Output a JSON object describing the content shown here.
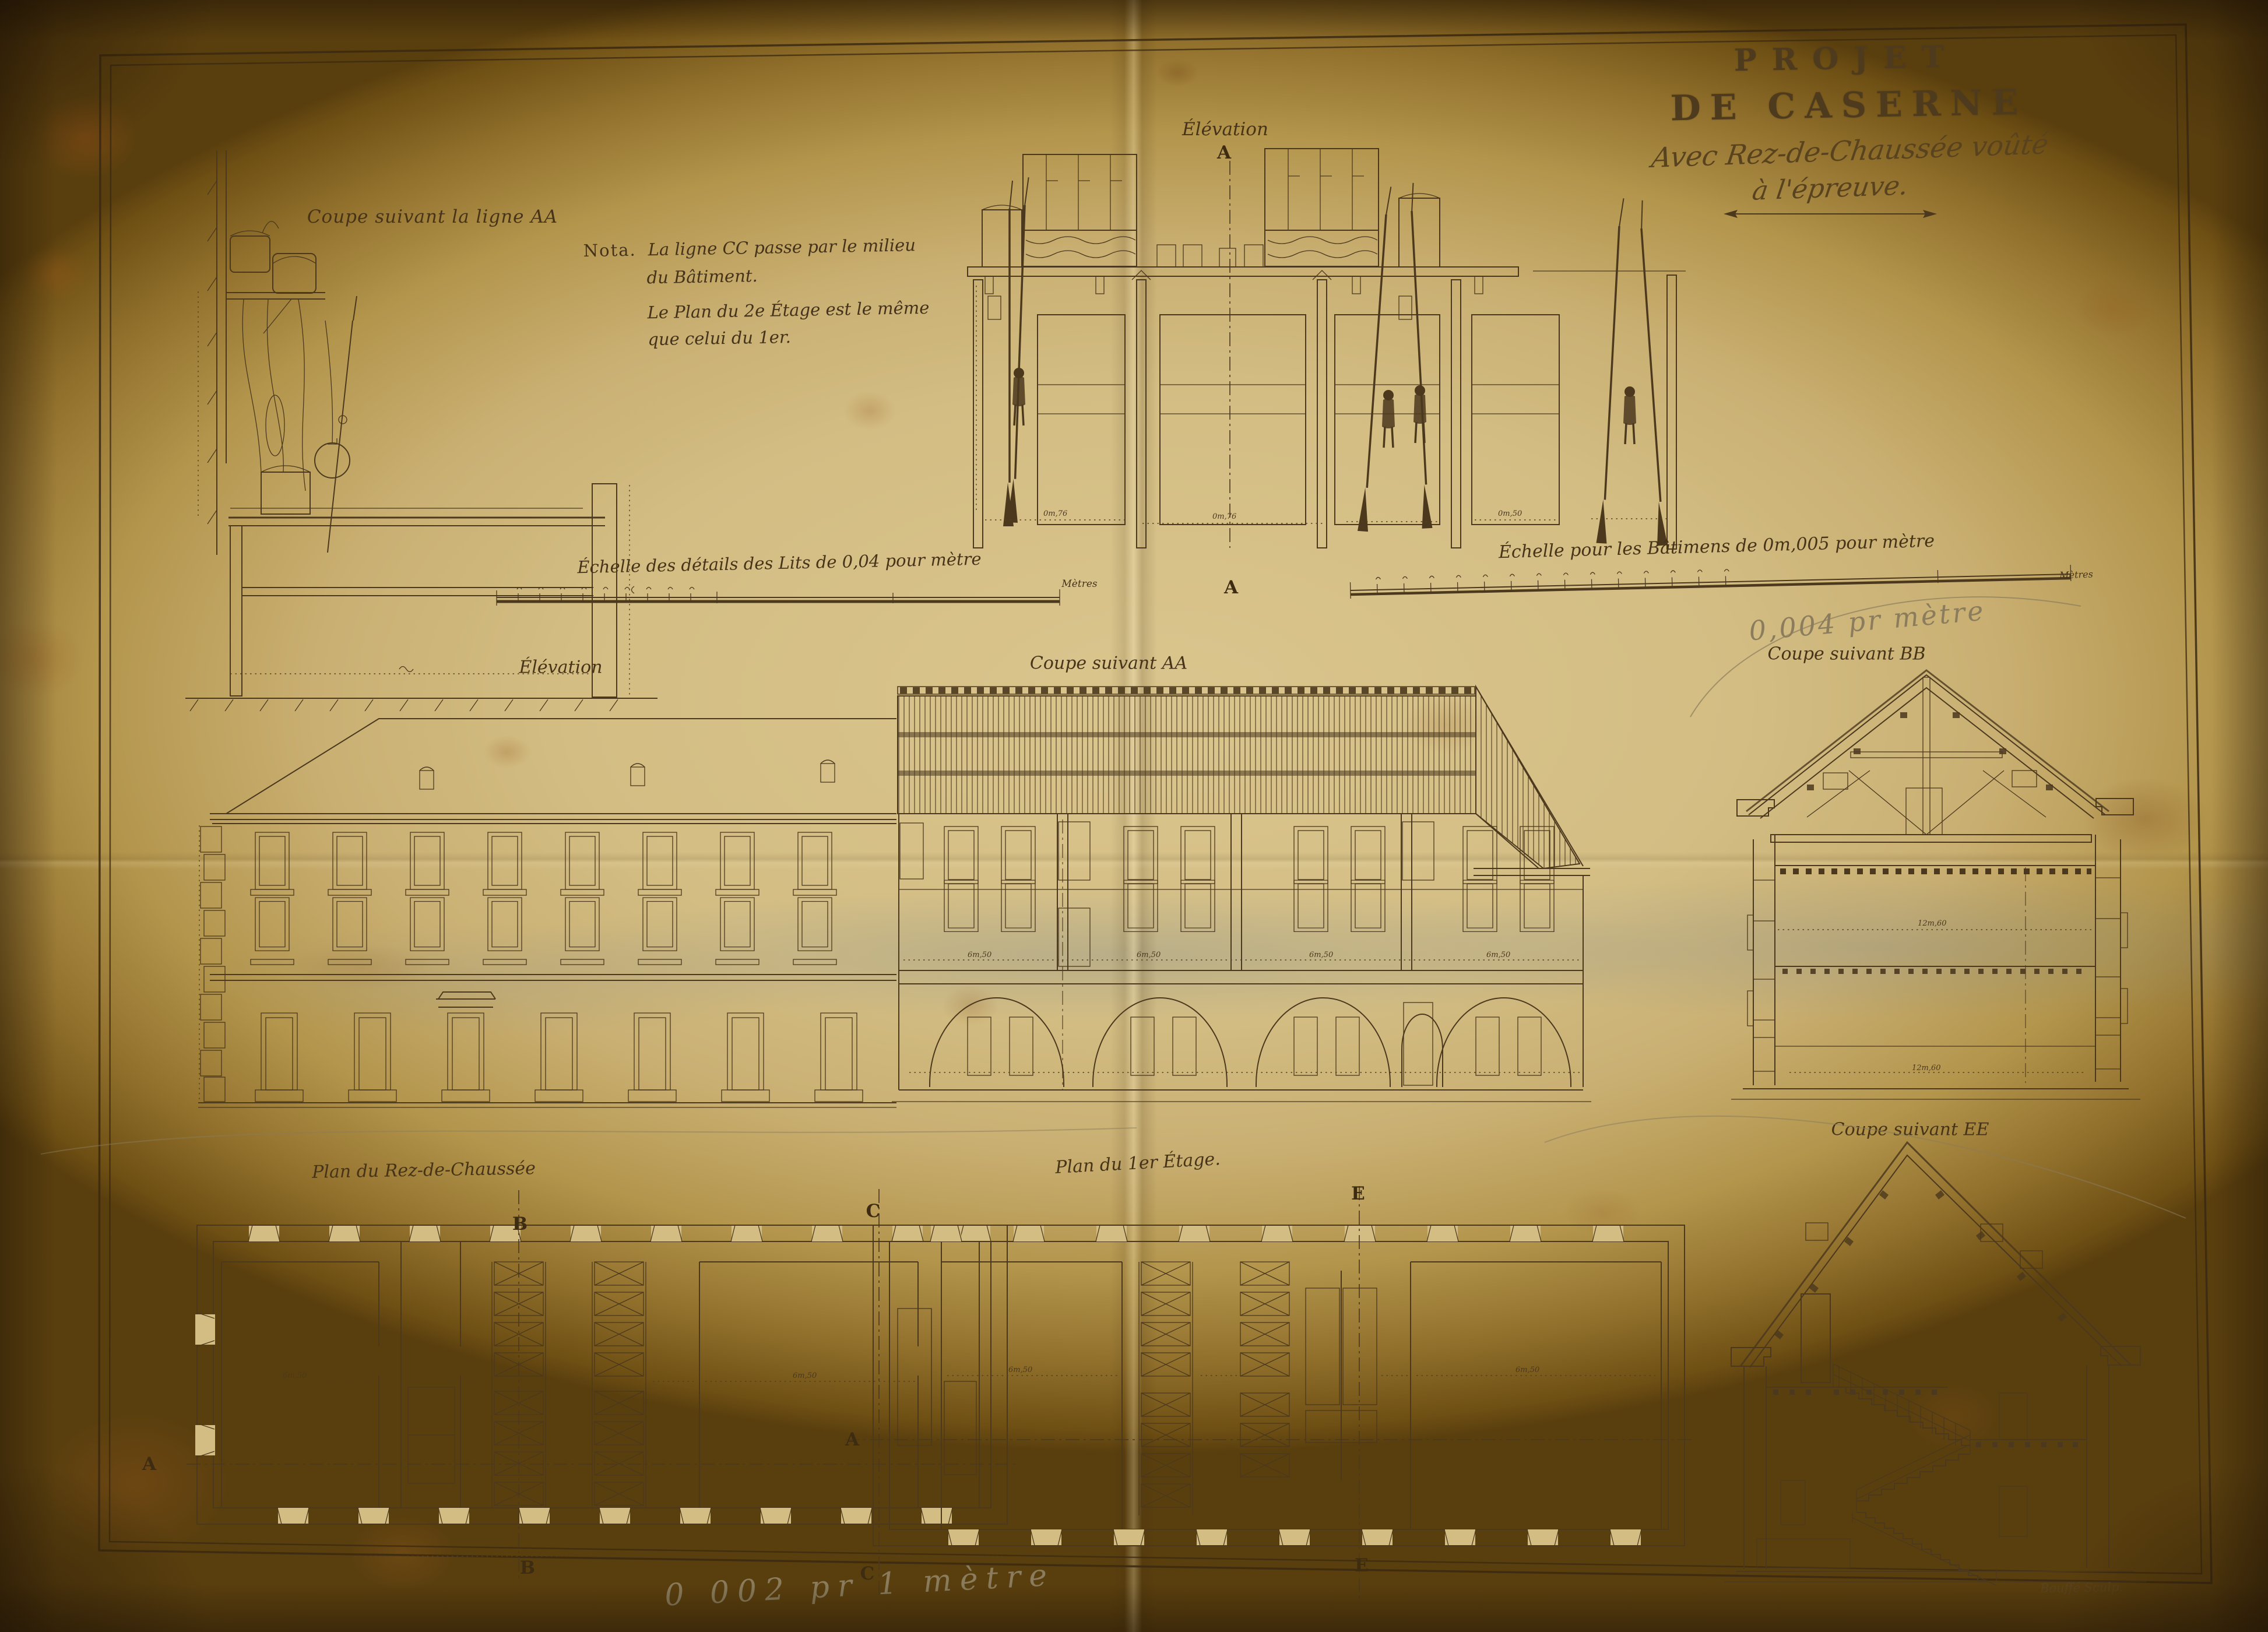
{
  "title": {
    "line1": "PROJET",
    "line2": "DE CASERNE",
    "line3": "Avec Rez-de-Chaussée voûté",
    "line4": "à l'épreuve."
  },
  "notes": {
    "nota_label": "Nota.",
    "nota_l1": "La ligne CC passe par le milieu",
    "nota_l2": "du Bâtiment.",
    "nota_l3": "Le Plan du 2e Étage est le même",
    "nota_l4": "que celui du 1er."
  },
  "labels": {
    "coupe_ligne_aa": "Coupe suivant la ligne AA",
    "elevation_detail": "Élévation",
    "elevation_building": "Élévation",
    "coupe_aa": "Coupe suivant AA",
    "coupe_bb": "Coupe suivant BB",
    "coupe_ee": "Coupe suivant EE",
    "plan_rdc": "Plan du Rez-de-Chaussée",
    "plan_1er": "Plan du 1er Étage.",
    "echelle_lits": "Échelle des détails des Lits de 0,04 pour mètre",
    "echelle_batimens": "Échelle pour les Bâtimens de 0m,005 pour mètre",
    "metres": "Mètres"
  },
  "markers": {
    "a": "A",
    "b": "B",
    "c": "C",
    "e": "E"
  },
  "dims": {
    "bay": "6m,50",
    "total": "12m,60",
    "bed_w": "0m,76",
    "bed_s": "0m,50"
  },
  "annotations": {
    "pencil_scale_top": "0,004 pr mètre",
    "pencil_scale_bottom": "0 002 pr 1 mètre",
    "engraver_signature": "Bouffé Sculp."
  },
  "colors": {
    "ink": "#4b381d",
    "paper": "#d3bd83",
    "pencil": "#8a7c5c"
  }
}
